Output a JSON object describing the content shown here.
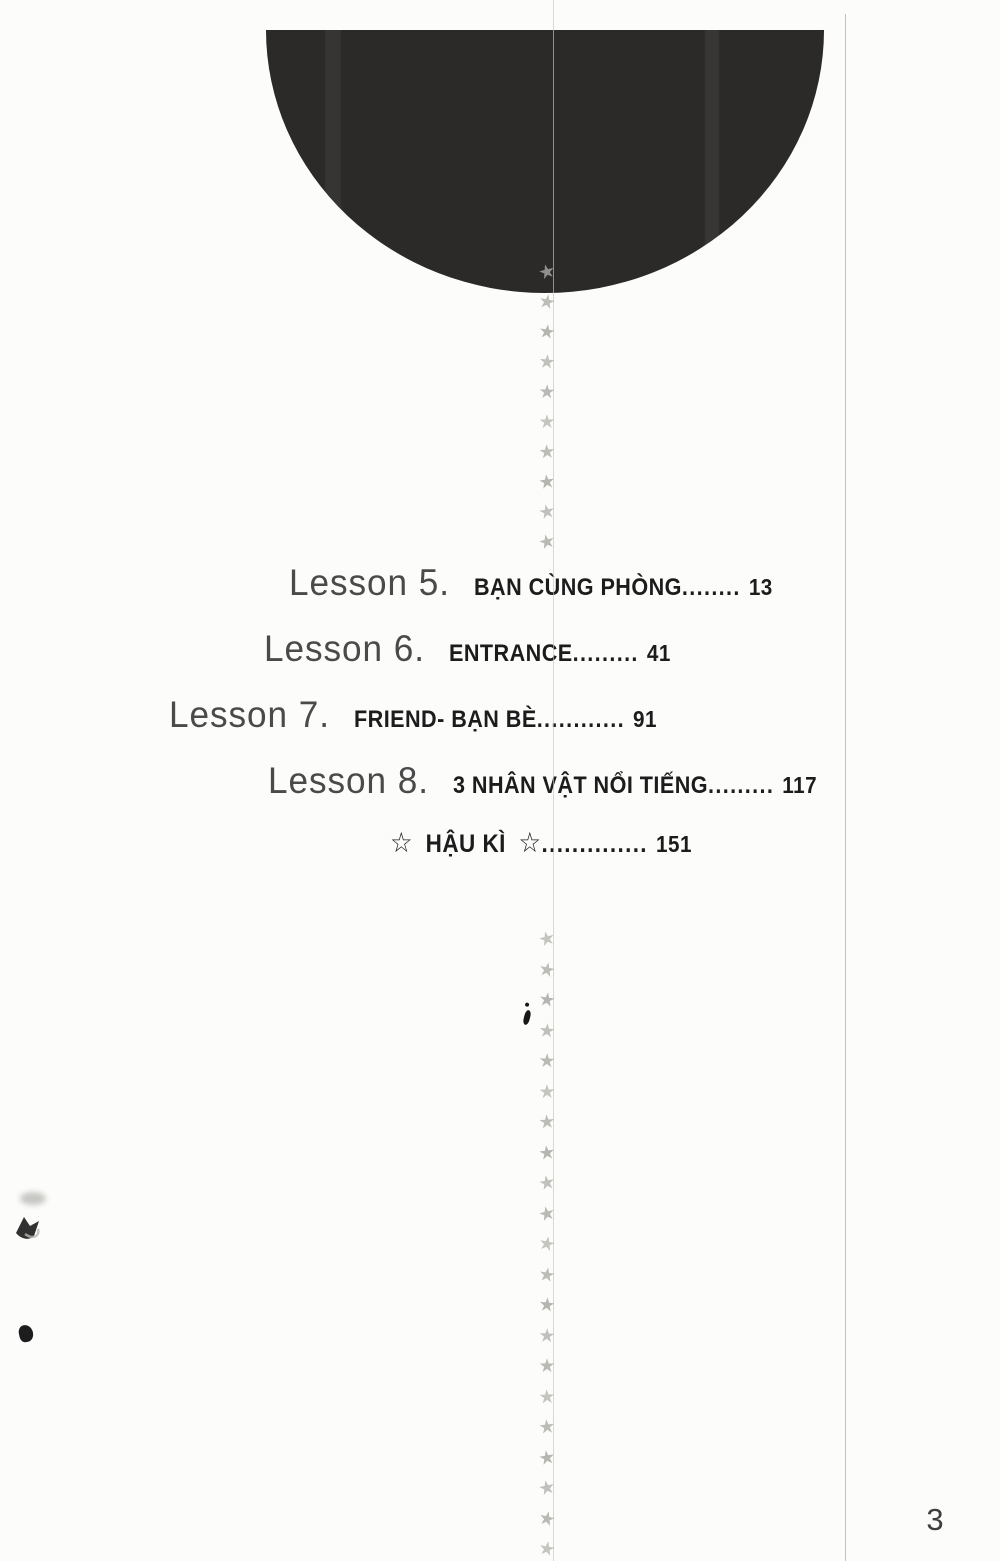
{
  "toc": {
    "items": [
      {
        "lesson": "Lesson 5.",
        "title": "BẠN CÙNG PHÒNG",
        "dots": "........",
        "page": "13"
      },
      {
        "lesson": "Lesson 6.",
        "title": "ENTRANCE",
        "dots": ".........",
        "page": "41"
      },
      {
        "lesson": "Lesson 7.",
        "title": "FRIEND- BẠN BÈ",
        "dots": "............",
        "page": "91"
      },
      {
        "lesson": "Lesson 8.",
        "title": "3 NHÂN VẬT NỔI TIẾNG",
        "dots": ".........",
        "page": "117"
      }
    ],
    "epilogue": {
      "pre_star": "☆",
      "label": "HẬU KÌ",
      "post_star": "☆",
      "dots": "..............",
      "page": "151"
    }
  },
  "page": {
    "number": "3"
  },
  "decor": {
    "star_char": "★",
    "upper_star_count": 10,
    "lower_star_count": 21,
    "colors": {
      "circle": "#2b2a28",
      "star": "#b3b2ac",
      "title_ink": "#1c1c1c",
      "lesson_ink": "#4a4a4a",
      "paper": "#fcfcfb"
    }
  }
}
